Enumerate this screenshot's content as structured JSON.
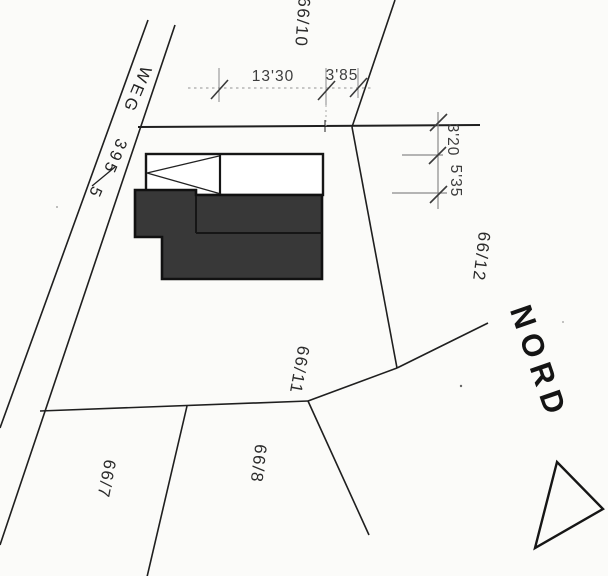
{
  "road": {
    "name": "WEG",
    "parcel_number": "395",
    "parcel_suffix": "5",
    "full_label": "WEG 395/5"
  },
  "parcels": {
    "p66_10": "66/10",
    "p66_12": "66/12",
    "p66_11": "66/11",
    "p66_8": "66/8",
    "p66_7": "66/7"
  },
  "dimensions": {
    "top_width_main": "13'30",
    "top_width_side": "3'85",
    "right_depth_upper": "3'20",
    "right_depth_lower": "5'35"
  },
  "north": {
    "label": "NORD"
  },
  "colors": {
    "ink": "#1f1f1f",
    "building_fill": "#383838",
    "dimension_light": "#a8a8a8"
  }
}
